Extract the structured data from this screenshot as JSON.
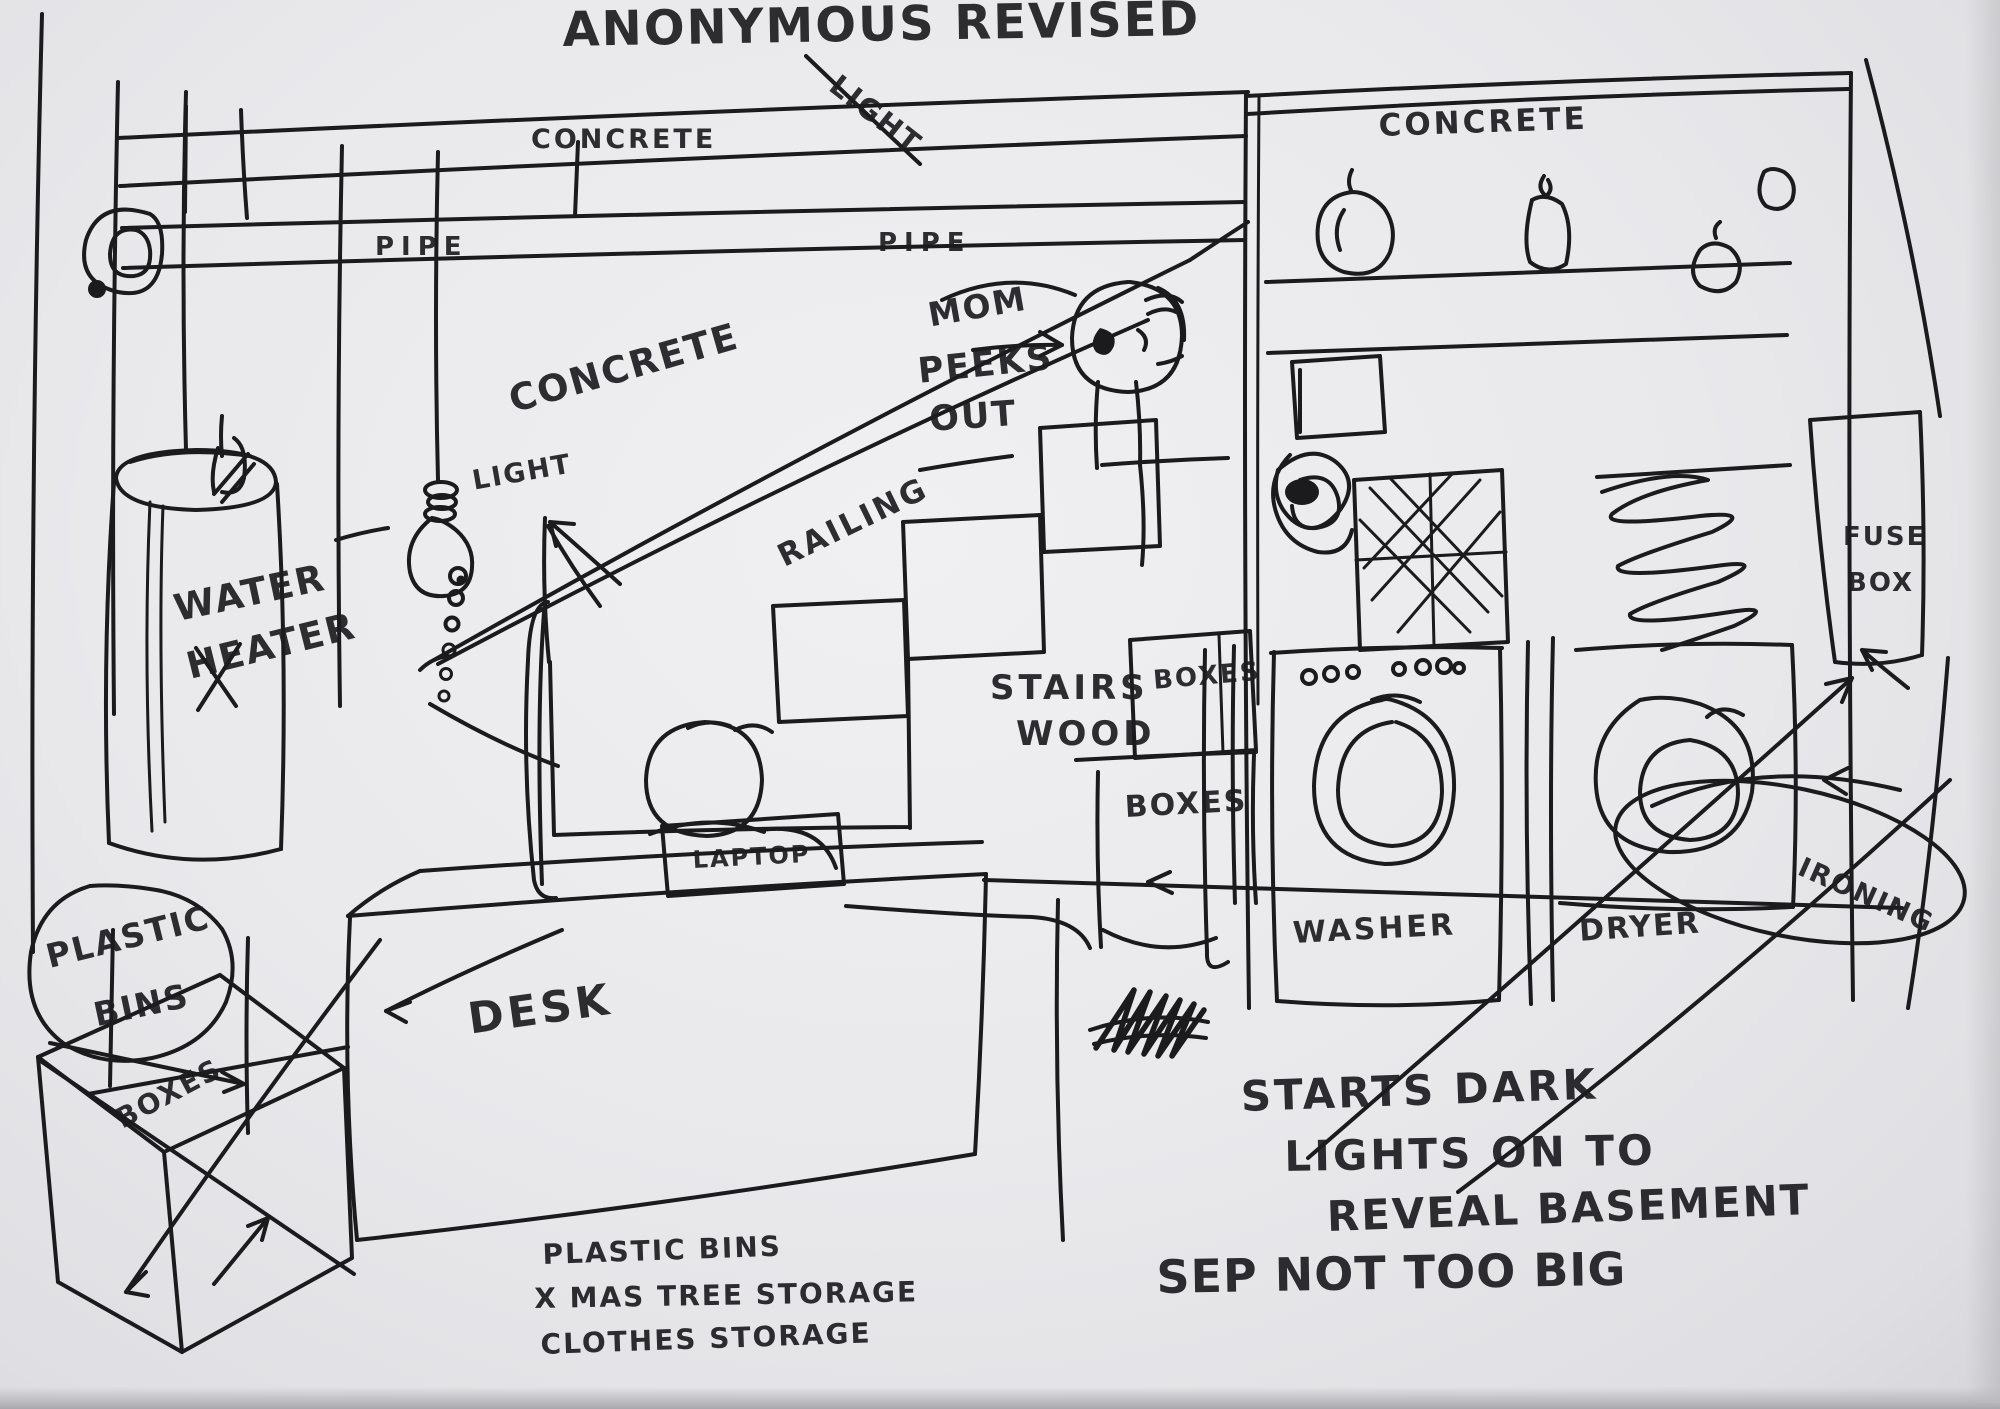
{
  "title": "ANONYMOUS REVISED",
  "callouts": {
    "light_ceiling": "LIGHT",
    "light_bulb": "LIGHT",
    "mom_line1": "MOM",
    "mom_line2": "PEEKS",
    "mom_line3": "OUT"
  },
  "surfaces": {
    "concrete_beam": "CONCRETE",
    "concrete_wall": "CONCRETE",
    "concrete_laundry": "CONCRETE",
    "pipe_left": "PIPE",
    "pipe_right": "PIPE",
    "railing": "RAILING",
    "stairs_line1": "STAIRS",
    "stairs_line2": "WOOD"
  },
  "objects": {
    "water_heater_line1": "WATER",
    "water_heater_line2": "HEATER",
    "plastic_bins_line1": "PLASTIC",
    "plastic_bins_line2": "BINS",
    "boxes_floor": "BOXES",
    "boxes_shelf": "BOXES",
    "boxes_under_stairs": "BOXES",
    "desk": "DESK",
    "laptop": "LAPTOP",
    "washer": "WASHER",
    "dryer": "DRYER",
    "ironing": "IRONING",
    "fuse_box_line1": "FUSE",
    "fuse_box_line2": "BOX"
  },
  "notes": {
    "lighting_line1": "STARTS DARK",
    "lighting_line2": "LIGHTS ON TO",
    "lighting_line3": "REVEAL BASEMENT",
    "size_note": "SEP NOT TOO BIG",
    "storage_line1": "PLASTIC BINS",
    "storage_line2": "X MAS TREE STORAGE",
    "storage_line3": "CLOTHES STORAGE"
  }
}
